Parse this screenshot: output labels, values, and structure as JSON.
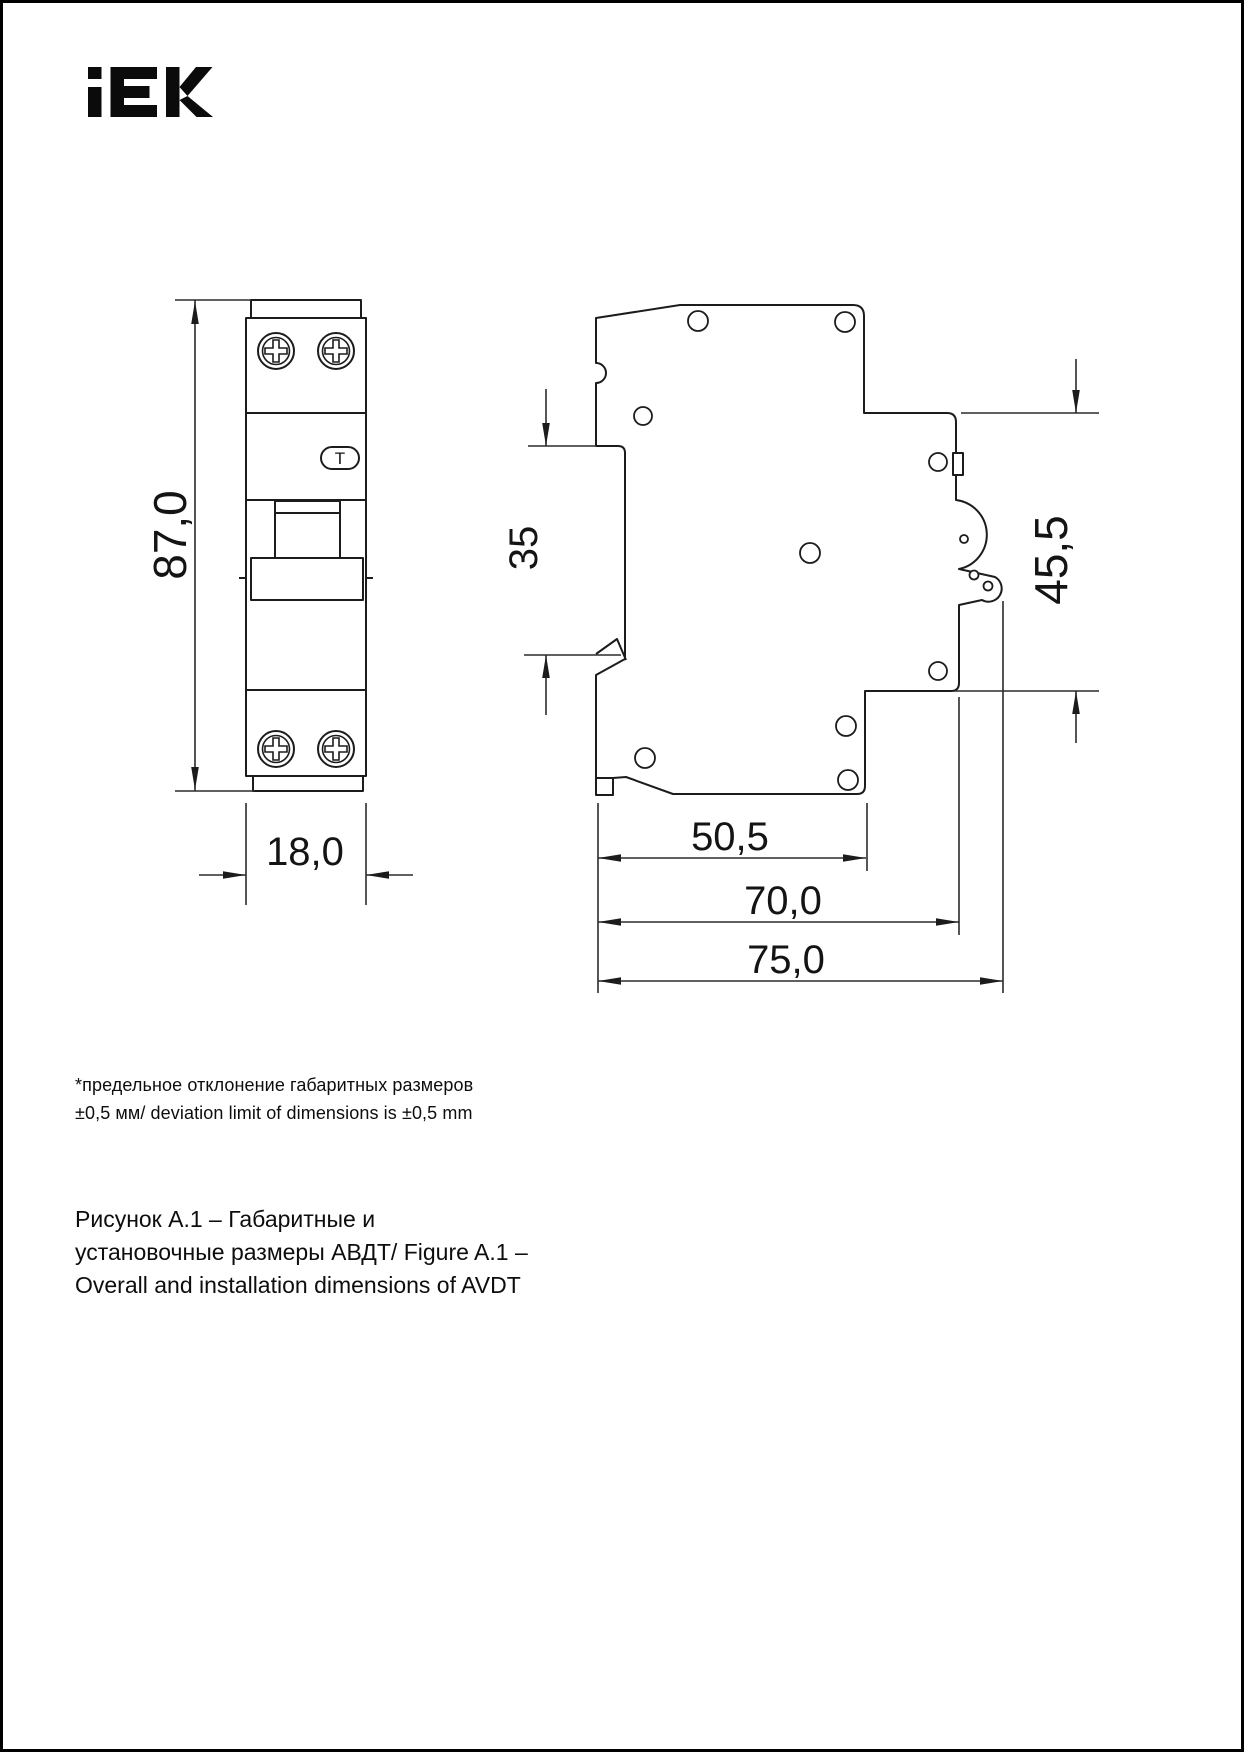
{
  "logo": {
    "text": "IEK"
  },
  "front_view": {
    "height_label": "87,0",
    "width_label": "18,0",
    "test_button": "T"
  },
  "side_view": {
    "din_rail_label": "35",
    "front_height_label": "45,5",
    "depth_body_label": "50,5",
    "depth_face_label": "70,0",
    "depth_total_label": "75,0"
  },
  "footnote": {
    "lines": [
      "*предельное отклонение габаритных размеров",
      "±0,5 мм/ deviation limit of dimensions is ±0,5 mm"
    ]
  },
  "caption": {
    "lines": [
      "Рисунок А.1 – Габаритные и",
      "установочные размеры АВДТ/ Figure A.1 –",
      "Overall and installation dimensions of AVDT"
    ]
  }
}
